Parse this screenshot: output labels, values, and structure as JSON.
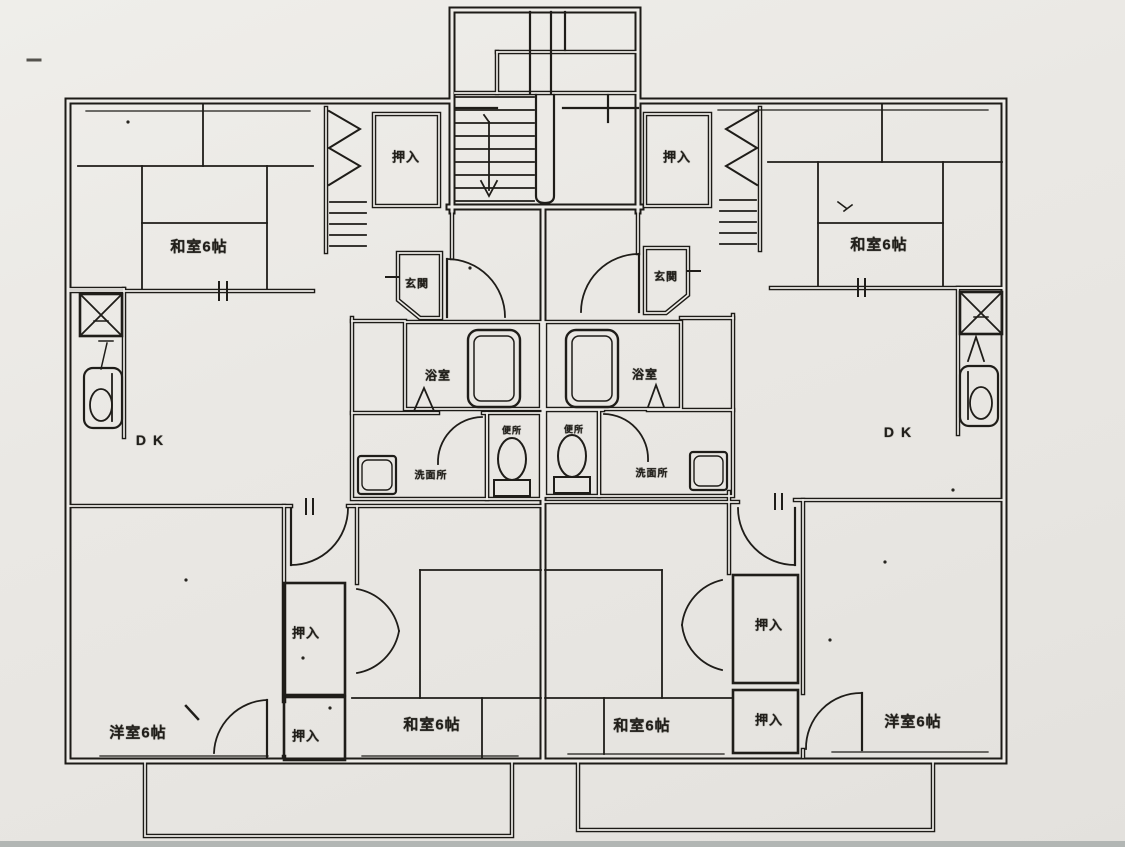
{
  "plan": {
    "kind": "scanned apartment floor plan, two mirrored units",
    "labels": {
      "closet": "押入",
      "japanese_room_6": "和室6帖",
      "western_room_6": "洋室6帖",
      "entrance": "玄関",
      "bath": "浴室",
      "toilet": "便所",
      "washroom": "洗面所",
      "dining_kitchen": "DK"
    }
  }
}
